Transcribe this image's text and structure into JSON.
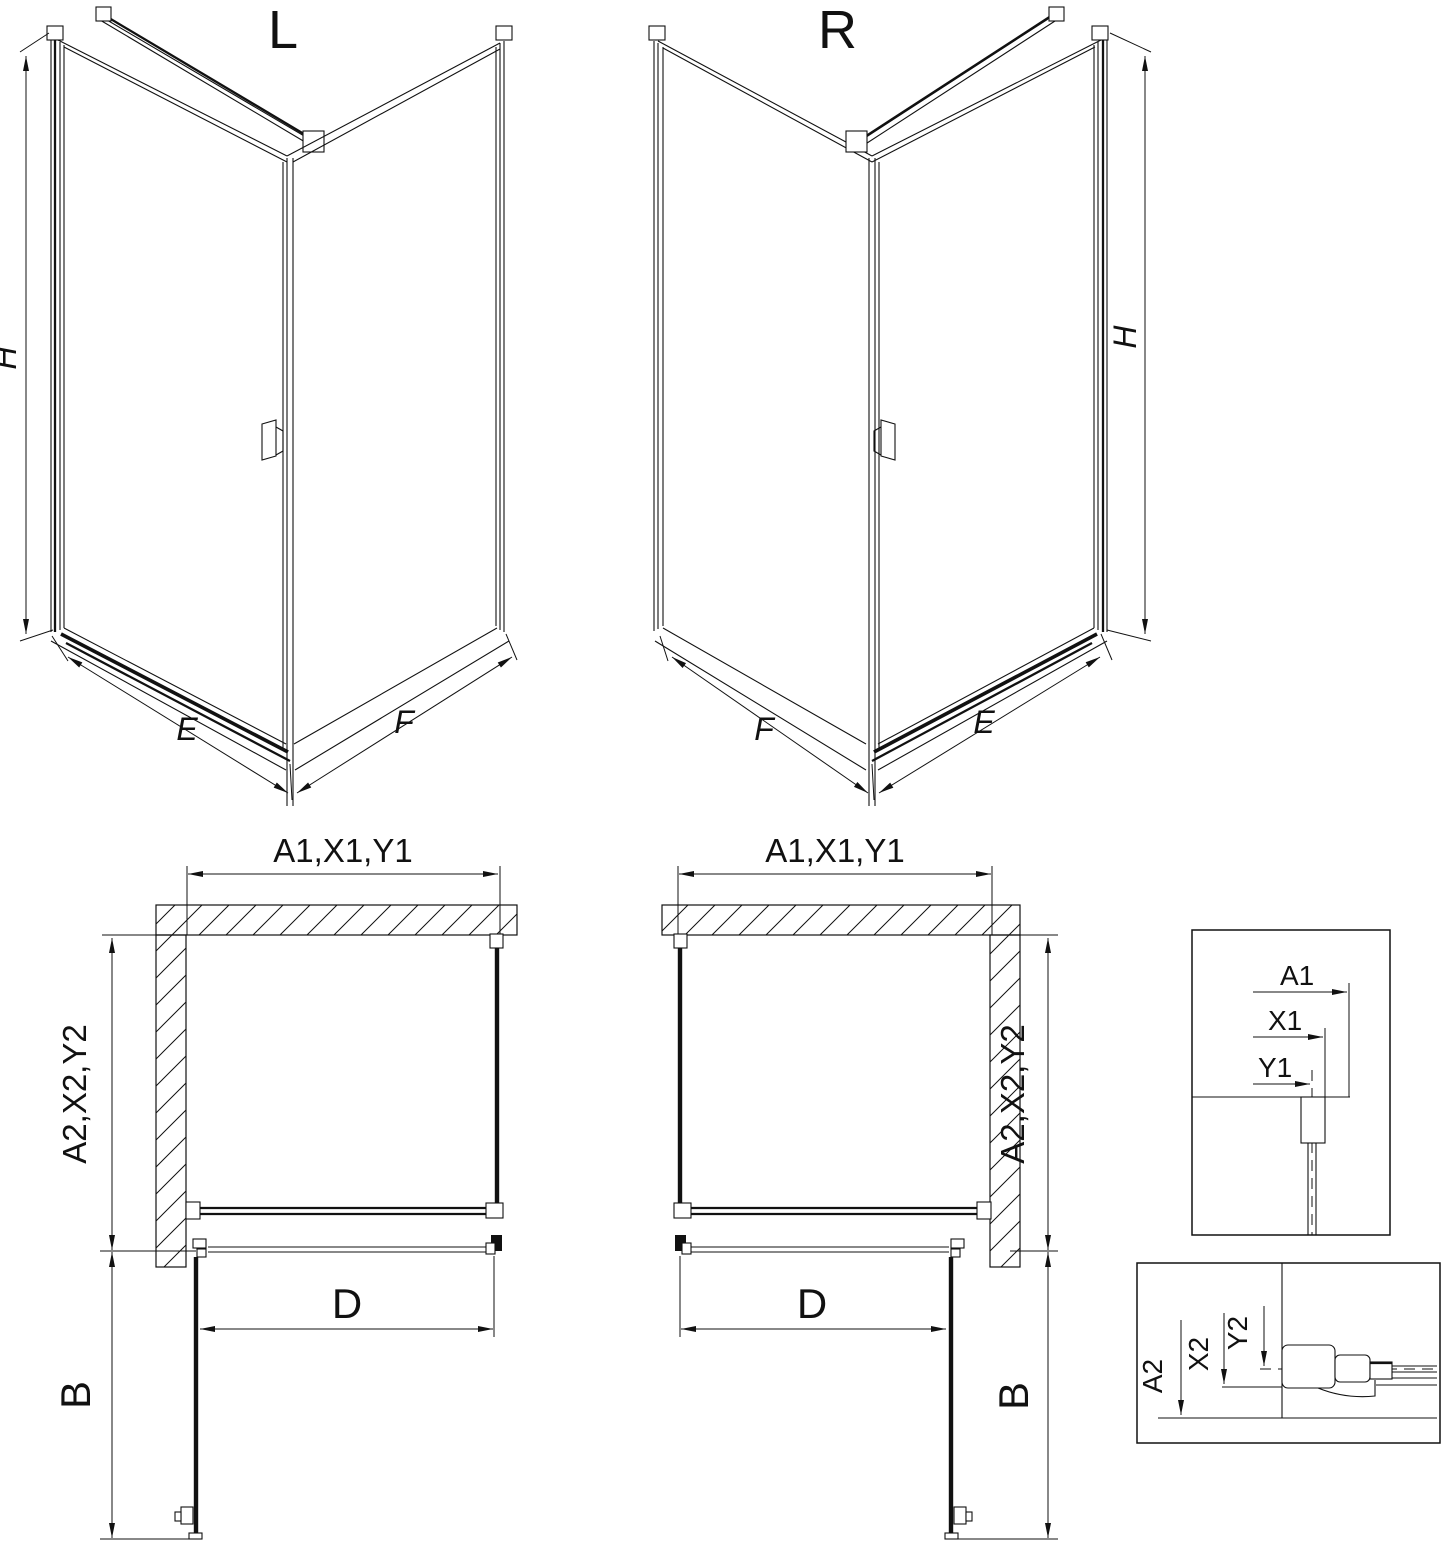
{
  "drawing": {
    "background": "#ffffff",
    "stroke_color": "#111111",
    "iso_left": {
      "variant": "L",
      "height": "H",
      "base_left": "E",
      "base_right": "F"
    },
    "iso_right": {
      "variant": "R",
      "height": "H",
      "base_left": "F",
      "base_right": "E"
    },
    "plan_left": {
      "width_dim": "A1,X1,Y1",
      "depth_dim": "A2,X2,Y2",
      "door_dim": "D",
      "front_dim": "B"
    },
    "plan_right": {
      "width_dim": "A1,X1,Y1",
      "depth_dim": "A2,X2,Y2",
      "door_dim": "D",
      "front_dim": "B"
    },
    "detail_width": {
      "outer": "A1",
      "middle": "X1",
      "inner": "Y1"
    },
    "detail_depth": {
      "outer": "A2",
      "middle": "X2",
      "inner": "Y2"
    }
  }
}
